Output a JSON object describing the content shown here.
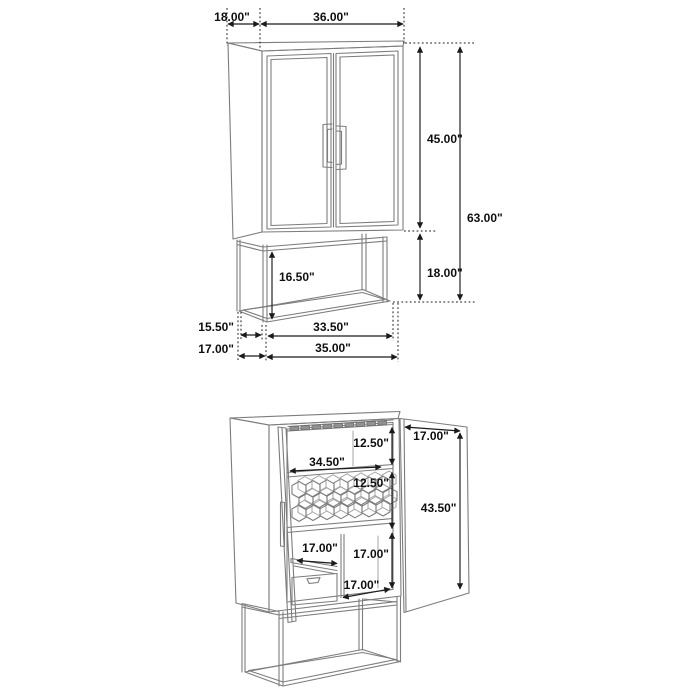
{
  "page": {
    "type": "furniture-dimension-diagram",
    "background": "#ffffff"
  },
  "colors": {
    "furniture_line": "#7d7d7d",
    "dimension_line": "#1a1a1a",
    "label_text": "#0f0f0f",
    "rack_block_fill": "#919191"
  },
  "closed_view": {
    "dims": {
      "top_depth": "18.00\"",
      "top_width": "36.00\"",
      "cabinet_section_height": "45.00\"",
      "overall_height": "63.00\"",
      "base_height": "18.00\"",
      "base_opening_height": "16.50\"",
      "base_depth_inner": "15.50\"",
      "base_depth_outer": "17.00\"",
      "base_width_inner": "33.50\"",
      "base_width_outer": "35.00\""
    }
  },
  "open_view": {
    "dims": {
      "stemware_section_height": "12.50\"",
      "interior_width": "34.50\"",
      "wine_rack_section_height": "12.50\"",
      "door_width": "17.00\"",
      "door_interior_height": "43.50\"",
      "drawer_width": "17.00\"",
      "lower_section_height": "17.00\"",
      "bottom_shelf_depth": "17.00\""
    }
  }
}
